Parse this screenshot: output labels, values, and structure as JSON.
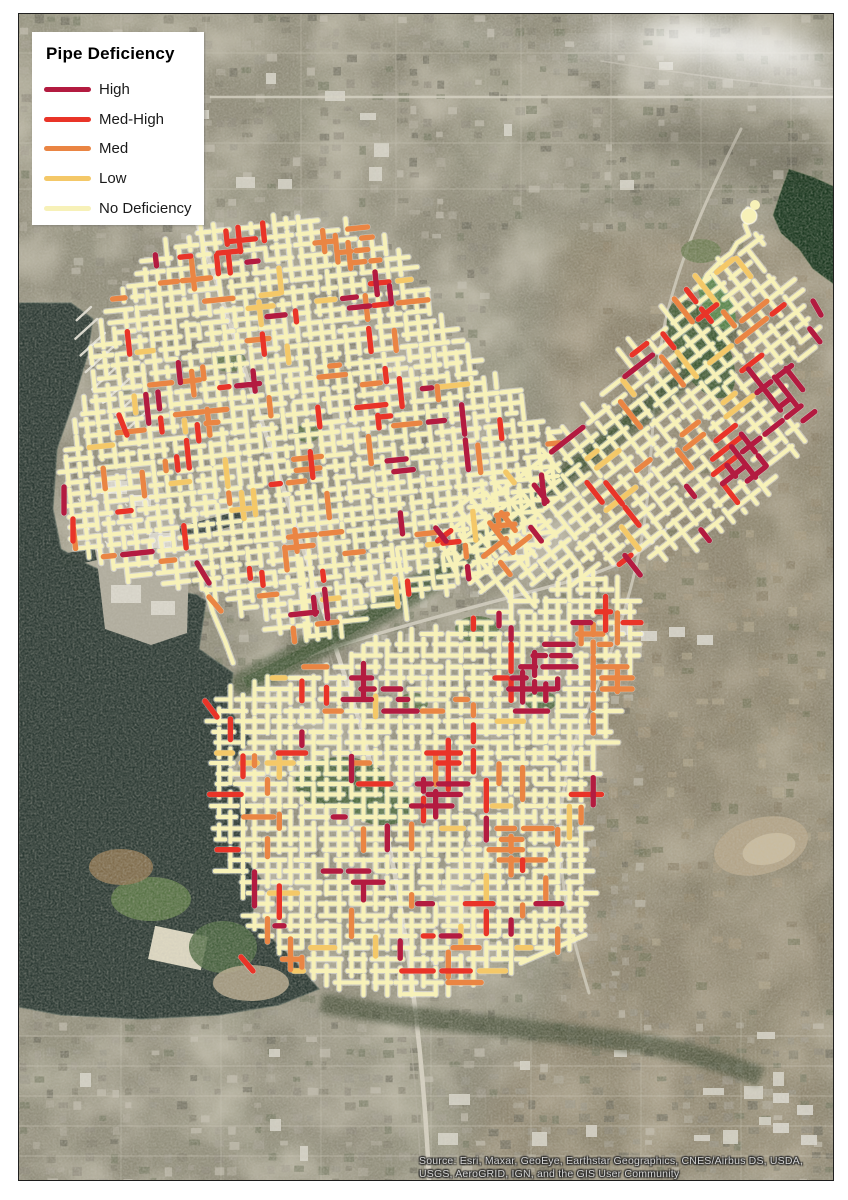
{
  "legend": {
    "title": "Pipe Deficiency",
    "items": [
      {
        "key": "high",
        "label": "High",
        "color": "#b31b40"
      },
      {
        "key": "medhigh",
        "label": "Med-High",
        "color": "#e93428"
      },
      {
        "key": "med",
        "label": "Med",
        "color": "#ea8543"
      },
      {
        "key": "low",
        "label": "Low",
        "color": "#f4c868"
      },
      {
        "key": "none",
        "label": "No Deficiency",
        "color": "#f7f1b8"
      }
    ]
  },
  "attribution": {
    "line1": "Source: Esri, Maxar, GeoEye, Earthstar Geographics, CNES/Airbus DS, USDA,",
    "line2": "USGS, AeroGRID, IGN, and the GIS User Community"
  }
}
